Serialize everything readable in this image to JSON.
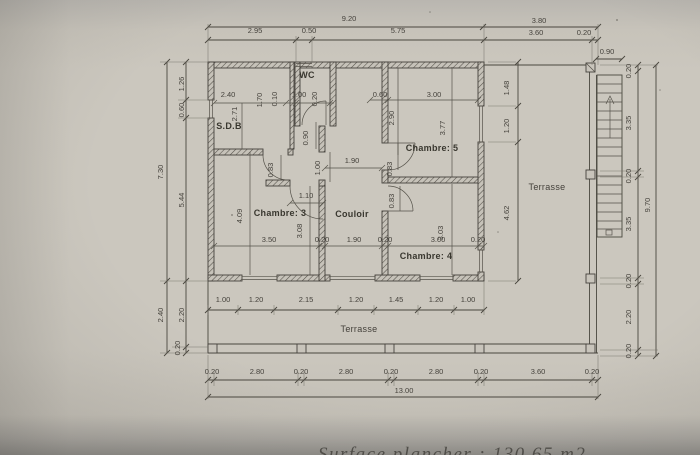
{
  "document": {
    "footer_partial_text": "Surface plancher :   130,65 m2"
  },
  "colors": {
    "paper": "#cbc7be",
    "ink": "#45423c",
    "bottom_shadow": "#908e89"
  },
  "plan": {
    "room_labels": [
      {
        "v": "S.D.B",
        "x": 229,
        "y": 129,
        "b": 1
      },
      {
        "v": "WC",
        "x": 307,
        "y": 78,
        "b": 1
      },
      {
        "v": "Chambre: 5",
        "x": 432,
        "y": 151,
        "b": 1
      },
      {
        "v": "Chambre: 3",
        "x": 280,
        "y": 216,
        "b": 1
      },
      {
        "v": "Couloir",
        "x": 352,
        "y": 217,
        "b": 1
      },
      {
        "v": "Chambre: 4",
        "x": 426,
        "y": 259,
        "b": 1
      },
      {
        "v": "Terrasse",
        "x": 547,
        "y": 190
      },
      {
        "v": "Terrasse",
        "x": 359,
        "y": 332
      }
    ],
    "dims": [
      {
        "v": "9.20",
        "x": 349,
        "y": 21
      },
      {
        "v": "2.95",
        "x": 255,
        "y": 33
      },
      {
        "v": "0.50",
        "x": 309,
        "y": 33
      },
      {
        "v": "5.75",
        "x": 398,
        "y": 33
      },
      {
        "v": "3.80",
        "x": 539,
        "y": 23
      },
      {
        "v": "3.60",
        "x": 536,
        "y": 35
      },
      {
        "v": "0.20",
        "x": 584,
        "y": 35
      },
      {
        "v": "0.90",
        "x": 607,
        "y": 54
      },
      {
        "v": "2.40",
        "x": 228,
        "y": 97
      },
      {
        "v": "1.70",
        "x": 262,
        "y": 100,
        "r": 1
      },
      {
        "v": "0.10",
        "x": 277,
        "y": 99,
        "r": 1
      },
      {
        "v": "1.00",
        "x": 299,
        "y": 97
      },
      {
        "v": "0.20",
        "x": 317,
        "y": 99,
        "r": 1
      },
      {
        "v": "0.60",
        "x": 380,
        "y": 97
      },
      {
        "v": "3.00",
        "x": 434,
        "y": 97
      },
      {
        "v": "2.71",
        "x": 237,
        "y": 114,
        "r": 1
      },
      {
        "v": "2.90",
        "x": 394,
        "y": 118,
        "r": 1
      },
      {
        "v": "3.77",
        "x": 445,
        "y": 128,
        "r": 1
      },
      {
        "v": "0.90",
        "x": 308,
        "y": 138,
        "r": 1
      },
      {
        "v": "0.83",
        "x": 273,
        "y": 170,
        "r": 1
      },
      {
        "v": "1.00",
        "x": 320,
        "y": 168,
        "r": 1
      },
      {
        "v": "0.83",
        "x": 392,
        "y": 169,
        "r": 1
      },
      {
        "v": "1.90",
        "x": 352,
        "y": 163
      },
      {
        "v": "1.10",
        "x": 306,
        "y": 198
      },
      {
        "v": "4.09",
        "x": 242,
        "y": 216,
        "r": 1
      },
      {
        "v": "3.08",
        "x": 302,
        "y": 231,
        "r": 1
      },
      {
        "v": "0.83",
        "x": 394,
        "y": 201,
        "r": 1
      },
      {
        "v": "3.03",
        "x": 443,
        "y": 233,
        "r": 1
      },
      {
        "v": "3.50",
        "x": 269,
        "y": 242
      },
      {
        "v": "0.20",
        "x": 322,
        "y": 242
      },
      {
        "v": "1.90",
        "x": 354,
        "y": 242
      },
      {
        "v": "0.20",
        "x": 385,
        "y": 242
      },
      {
        "v": "3.00",
        "x": 438,
        "y": 242
      },
      {
        "v": "0.20",
        "x": 478,
        "y": 242
      },
      {
        "v": "7.30",
        "x": 163,
        "y": 172,
        "r": 1
      },
      {
        "v": "1.26",
        "x": 184,
        "y": 84,
        "r": 1
      },
      {
        "v": "0.60",
        "x": 184,
        "y": 110,
        "r": 1
      },
      {
        "v": "5.44",
        "x": 184,
        "y": 200,
        "r": 1
      },
      {
        "v": "2.40",
        "x": 163,
        "y": 315,
        "r": 1
      },
      {
        "v": "2.20",
        "x": 184,
        "y": 315,
        "r": 1
      },
      {
        "v": "0.20",
        "x": 180,
        "y": 348,
        "r": 1
      },
      {
        "v": "1.48",
        "x": 509,
        "y": 88,
        "r": 1
      },
      {
        "v": "1.20",
        "x": 509,
        "y": 126,
        "r": 1
      },
      {
        "v": "4.62",
        "x": 509,
        "y": 213,
        "r": 1
      },
      {
        "v": "0.20",
        "x": 631,
        "y": 71,
        "r": 1
      },
      {
        "v": "3.35",
        "x": 631,
        "y": 123,
        "r": 1
      },
      {
        "v": "0.20",
        "x": 631,
        "y": 176,
        "r": 1
      },
      {
        "v": "3.35",
        "x": 631,
        "y": 224,
        "r": 1
      },
      {
        "v": "0.20",
        "x": 631,
        "y": 281,
        "r": 1
      },
      {
        "v": "2.20",
        "x": 631,
        "y": 317,
        "r": 1
      },
      {
        "v": "0.20",
        "x": 631,
        "y": 351,
        "r": 1
      },
      {
        "v": "9.70",
        "x": 650,
        "y": 205,
        "r": 1
      },
      {
        "v": "1.00",
        "x": 223,
        "y": 302
      },
      {
        "v": "1.20",
        "x": 256,
        "y": 302
      },
      {
        "v": "2.15",
        "x": 306,
        "y": 302
      },
      {
        "v": "1.20",
        "x": 356,
        "y": 302
      },
      {
        "v": "1.45",
        "x": 396,
        "y": 302
      },
      {
        "v": "1.20",
        "x": 436,
        "y": 302
      },
      {
        "v": "1.00",
        "x": 468,
        "y": 302
      },
      {
        "v": "0.20",
        "x": 212,
        "y": 374
      },
      {
        "v": "2.80",
        "x": 257,
        "y": 374
      },
      {
        "v": "0.20",
        "x": 301,
        "y": 374
      },
      {
        "v": "2.80",
        "x": 346,
        "y": 374
      },
      {
        "v": "0.20",
        "x": 391,
        "y": 374
      },
      {
        "v": "2.80",
        "x": 436,
        "y": 374
      },
      {
        "v": "0.20",
        "x": 481,
        "y": 374
      },
      {
        "v": "3.60",
        "x": 538,
        "y": 374
      },
      {
        "v": "0.20",
        "x": 592,
        "y": 374
      },
      {
        "v": "13.00",
        "x": 404,
        "y": 393
      }
    ]
  }
}
